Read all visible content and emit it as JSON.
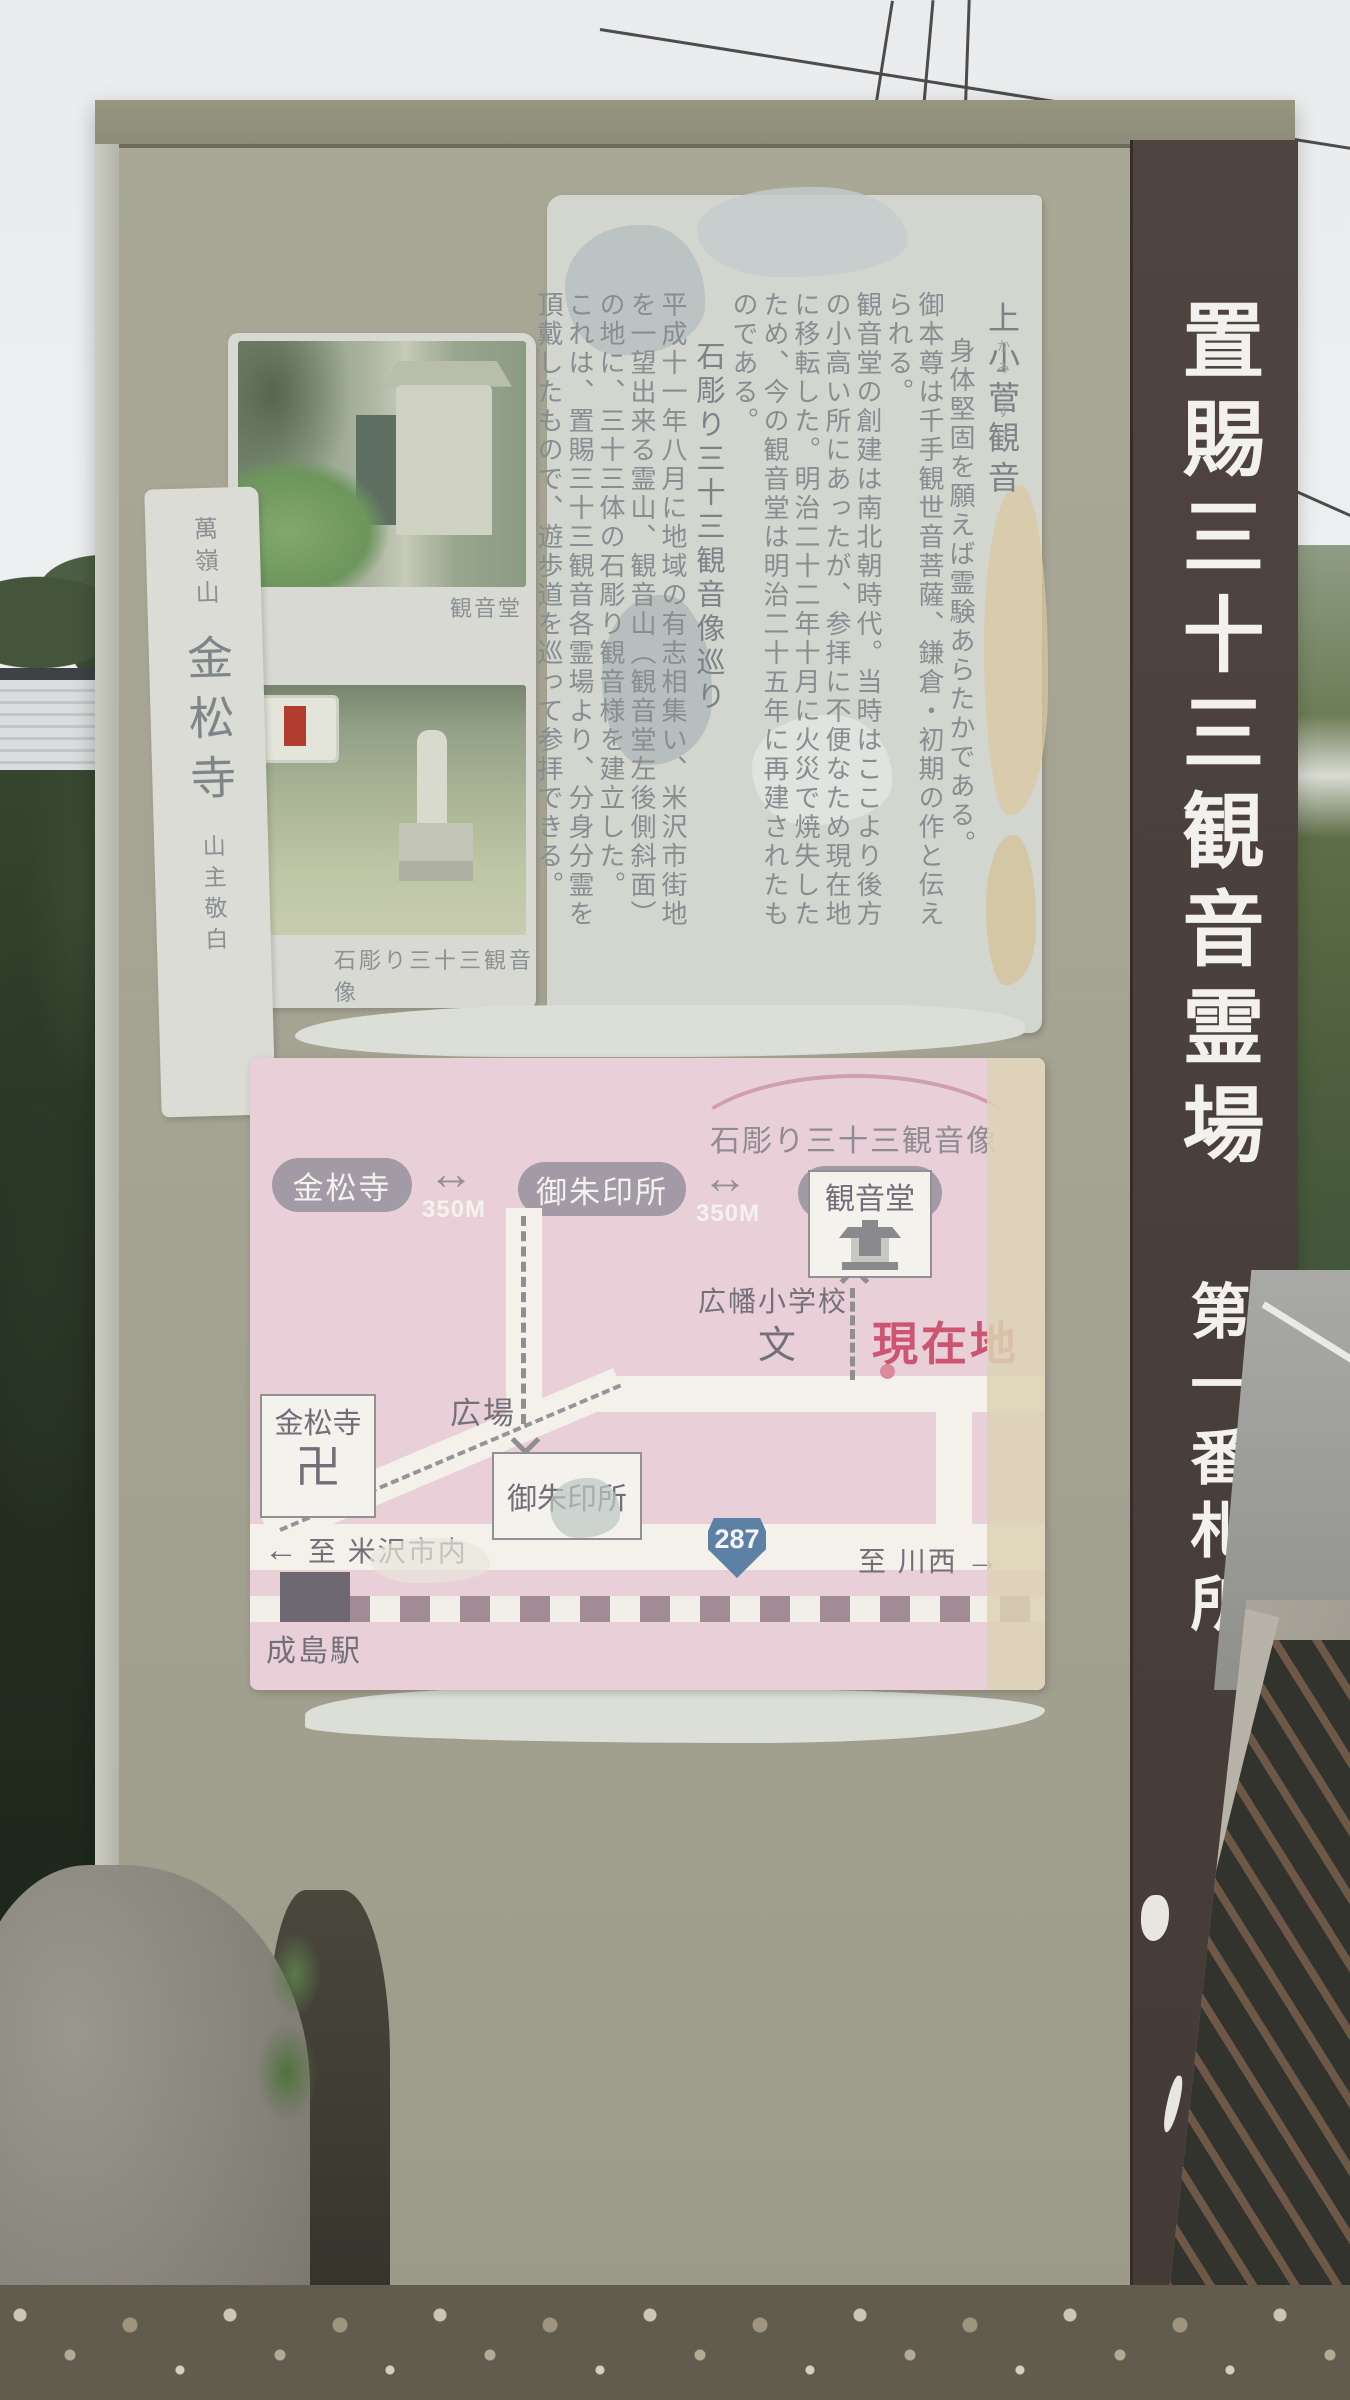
{
  "strip": {
    "title": "置賜三十三観音霊場",
    "rank": "第一番札所"
  },
  "notice": {
    "title": "上小菅観音",
    "furigana": "かみこすげ",
    "intro": "身体堅固を願えば霊験あらたかである。",
    "para1": "御本尊は千手観世音菩薩、鎌倉・初期の作と伝えられる。",
    "para2": "観音堂の創建は南北朝時代。当時はここより後方の小高い所にあったが、参拝に不便なため現在地に移転した。明治二十二年十月に火災で焼失したため、今の観音堂は明治二十五年に再建されたものである。",
    "section_title": "石彫り三十三観音像巡り",
    "para3": "平成十一年八月に地域の有志相集い、米沢市街地を一望出来る霊山、観音山（観音堂左後側斜面）の地に、三十三体の石彫り観音様を建立した。",
    "para4": "これは、置賜三十三観音各霊場より、分身分霊を頂戴したもので、遊歩道を巡って参拝できる。"
  },
  "photos": {
    "caption_top": "観音堂",
    "caption_bottom": "石彫り三十三観音像"
  },
  "signature": {
    "mountain": "萬嶺山",
    "temple": "金松寺",
    "closing": "山主敬白"
  },
  "map": {
    "arc_label": "石彫り三十三観音像",
    "legend": {
      "stop1": "金松寺",
      "arrow1": "↔",
      "dist1": "350M",
      "stop2": "御朱印所",
      "arrow2": "↔",
      "dist2": "350M",
      "stop3": "観音堂"
    },
    "kannondo": "観音堂",
    "school": "広幡小学校",
    "school_mark": "文",
    "you_are_here": "現在地",
    "plaza": "広場",
    "konshoji": "金松寺",
    "manji": "卍",
    "goshuin": "御朱印所",
    "left_arrow": "←",
    "to_yonezawa": "至 米沢市内",
    "route_number": "287",
    "to_kawanishi": "至 川西",
    "right_arrow": "→",
    "station": "成島駅"
  },
  "colors": {
    "board_khaki": "#a5a392",
    "strip_brown": "#4a3f3a",
    "map_pink": "#e9d0d8",
    "you_are_here_red": "#cc5571",
    "route_blue": "#5d80a5"
  }
}
